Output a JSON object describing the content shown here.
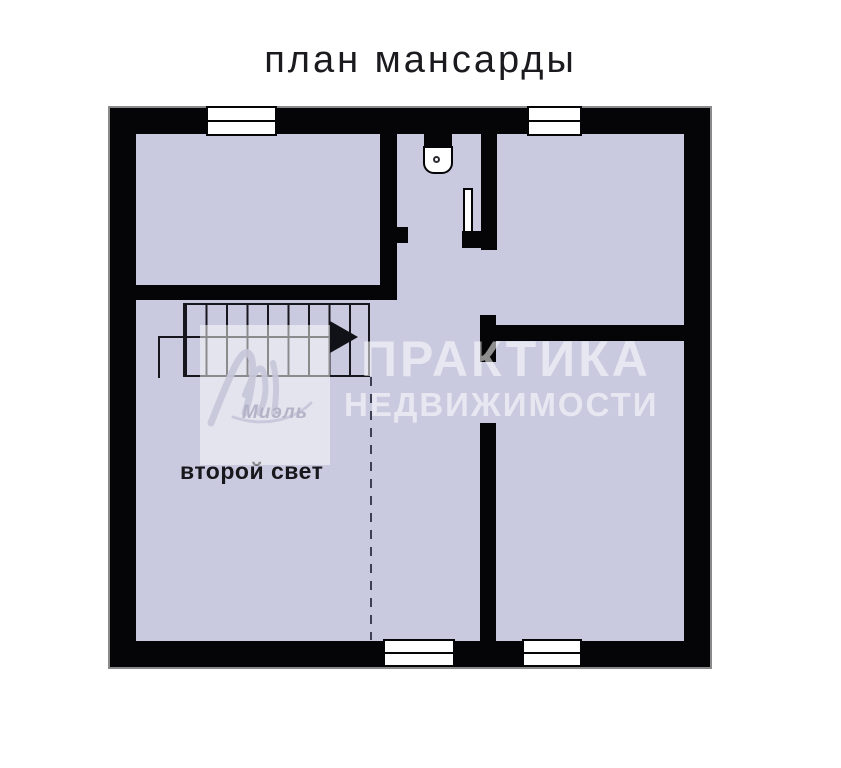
{
  "title": "план мансарды",
  "labels": {
    "void_space": "второй свет"
  },
  "watermark": {
    "line1": "ПРАКТИКА",
    "line2": "НЕДВИЖИМОСТИ",
    "logo_text": "Миэль"
  },
  "colors": {
    "page_bg": "#ffffff",
    "wall": "#050507",
    "room_fill": "#c9c9df",
    "outer_outline": "#8a8a8a",
    "dashed_line": "#3f3f52",
    "stair_line": "#16161c",
    "watermark_text": "rgba(255,255,255,0.55)",
    "logo_text_color": "#b3b3c7"
  }
}
